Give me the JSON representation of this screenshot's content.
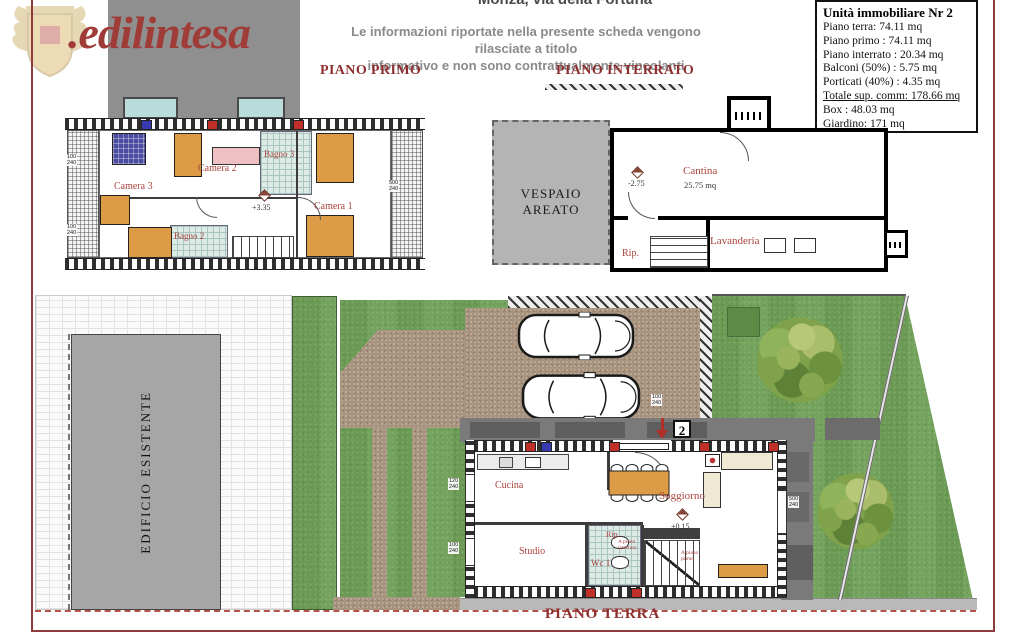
{
  "brand": {
    "logo_text": ".edilintesa",
    "crest_icon": "heraldic-crest"
  },
  "header": {
    "location_title": "Monza, via della Fortuna",
    "disclaimer_line1": "Le informazioni riportate nella presente scheda vengono rilasciate a titolo",
    "disclaimer_line2": "informativo e non sono contrattualmente vincolanti"
  },
  "info_box": {
    "title": "Unità immobiliare Nr 2",
    "rows": [
      "Piano terra: 74.11 mq",
      "Piano primo : 74.11 mq",
      "Piano interrato : 20.34 mq",
      "Balconi (50%) : 5.75 mq",
      "Porticati (40%) : 4.35 mq",
      "Totale sup. comm: 178.66 mq",
      "Box : 48.03 mq",
      "Giardino: 171 mq"
    ]
  },
  "piano_primo": {
    "heading": "PIANO PRIMO",
    "level": "+3.35",
    "rooms": {
      "camera1": "Camera 1",
      "camera2": "Camera 2",
      "camera3": "Camera 3",
      "bagno2": "Bagno 2",
      "bagno3": "Bagno 3"
    }
  },
  "piano_interrato": {
    "heading": "PIANO INTERRATO",
    "vespaio": "VESPAIO AREATO",
    "level": "-2.75",
    "rooms": {
      "cantina": "Cantina",
      "cantina_area": "25.75 mq",
      "rip": "Rip.",
      "lavanderia": "Lavanderia"
    }
  },
  "piano_terra": {
    "heading": "PIANO TERRA",
    "level": "+0.15",
    "unit_badge": "2",
    "existing_building": "EDIFICIO ESISTENTE",
    "stair_note_down": "A piano\ninterrato",
    "stair_note_up": "A piano\nprimo",
    "rooms": {
      "cucina": "Cucina",
      "soggiorno": "Soggiorno",
      "studio": "Studio",
      "wc": "Wc 1",
      "rip": "Rip."
    }
  },
  "dims": {
    "w100": "100\n240",
    "w120": "120\n240",
    "w500": "500\n240",
    "entry": "100\n240"
  },
  "colors": {
    "heading_red": "#8e2f2f",
    "room_label_red": "#a8423c",
    "frame_red": "#8d3b3b",
    "lawn_green": "#6fa057",
    "paving_brown": "#a8937e",
    "building_gray": "#8f8f8f",
    "tile_teal": "#ddeae6",
    "furniture_orange": "#dd9b45",
    "window_teal": "#b9dcdb"
  }
}
